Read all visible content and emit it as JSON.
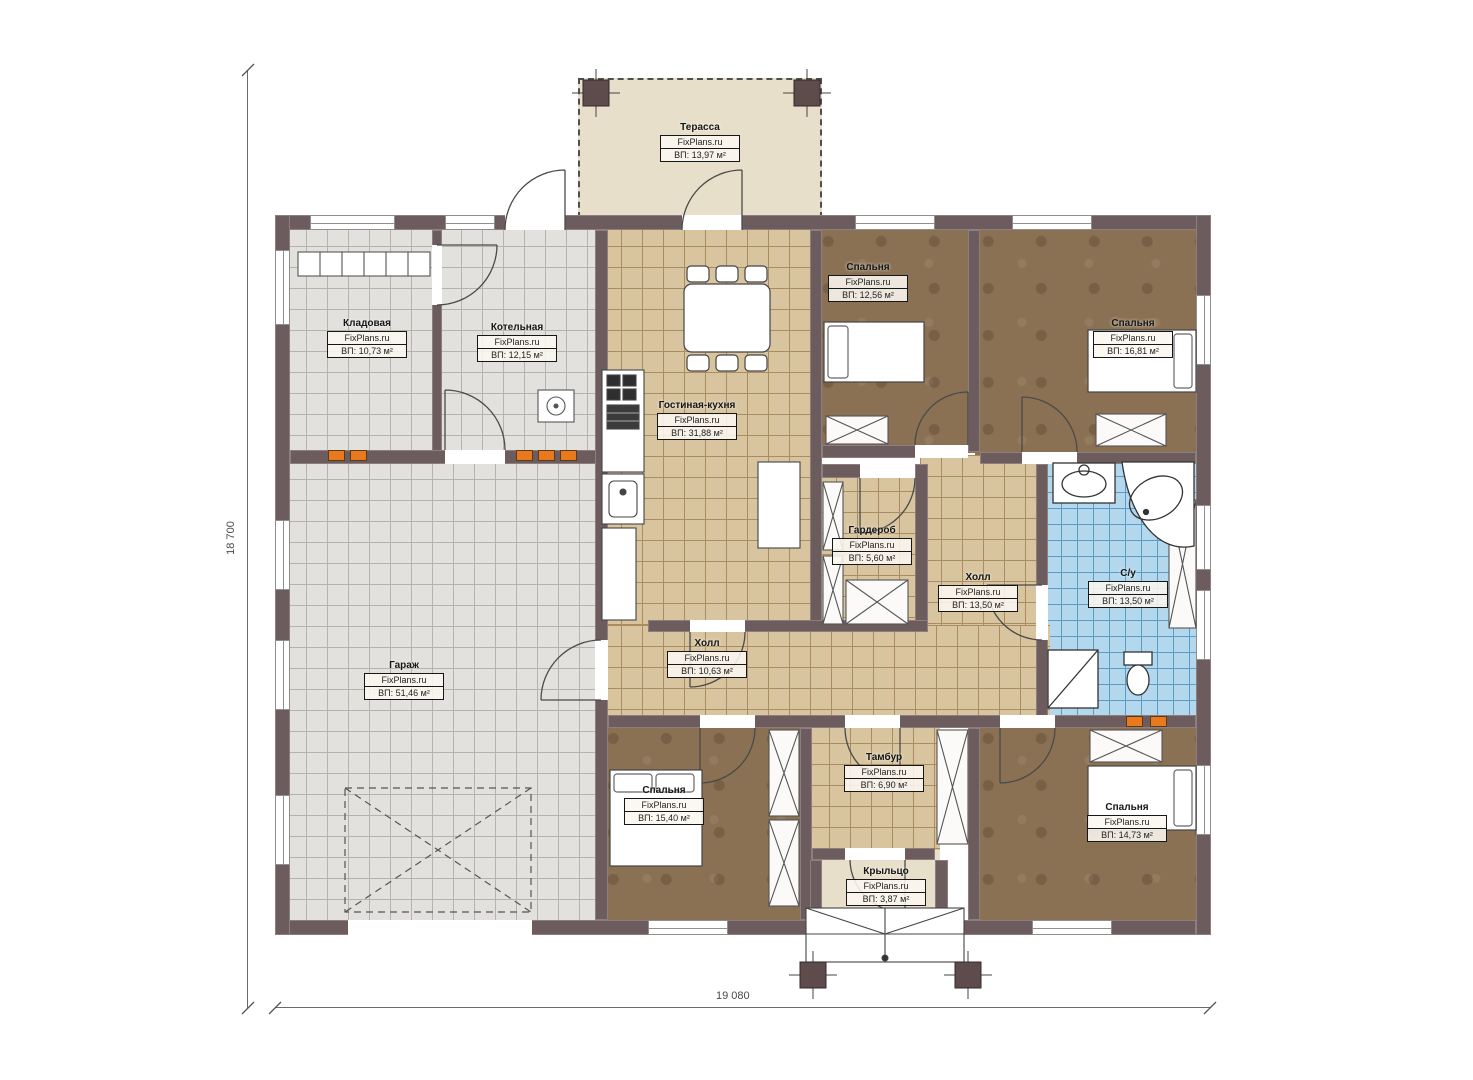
{
  "watermark": "FixPlans.ru",
  "dimensions": {
    "height_label": "18 700",
    "width_label": "19 080"
  },
  "colors": {
    "wall": "#6d5c5d",
    "tile_tan": "#d8c5a0",
    "tile_gray": "#e3e1de",
    "tile_blue": "#b3d7ed",
    "bedroom_brown": "#8a7153",
    "terrace_beige": "#e8dfca",
    "radiator_orange": "#e8791c"
  },
  "rooms": [
    {
      "name": "Терасса",
      "watermark": "FixPlans.ru",
      "area": "ВП: 13,97 м²"
    },
    {
      "name": "Кладовая",
      "watermark": "FixPlans.ru",
      "area": "ВП: 10,73 м²"
    },
    {
      "name": "Котельная",
      "watermark": "FixPlans.ru",
      "area": "ВП: 12,15 м²"
    },
    {
      "name": "Гостиная-кухня",
      "watermark": "FixPlans.ru",
      "area": "ВП: 31,88 м²"
    },
    {
      "name": "Спальня",
      "watermark": "FixPlans.ru",
      "area": "ВП: 12,56 м²"
    },
    {
      "name": "Спальня",
      "watermark": "FixPlans.ru",
      "area": "ВП: 16,81 м²"
    },
    {
      "name": "Гардероб",
      "watermark": "FixPlans.ru",
      "area": "ВП: 5,60 м²"
    },
    {
      "name": "Холл",
      "watermark": "FixPlans.ru",
      "area": "ВП: 13,50 м²"
    },
    {
      "name": "С/у",
      "watermark": "FixPlans.ru",
      "area": "ВП: 13,50 м²"
    },
    {
      "name": "Гараж",
      "watermark": "FixPlans.ru",
      "area": "ВП: 51,46 м²"
    },
    {
      "name": "Холл",
      "watermark": "FixPlans.ru",
      "area": "ВП: 10,63 м²"
    },
    {
      "name": "Спальня",
      "watermark": "FixPlans.ru",
      "area": "ВП: 15,40 м²"
    },
    {
      "name": "Тамбур",
      "watermark": "FixPlans.ru",
      "area": "ВП: 6,90 м²"
    },
    {
      "name": "Крыльцо",
      "watermark": "FixPlans.ru",
      "area": "ВП: 3,87 м²"
    },
    {
      "name": "Спальня",
      "watermark": "FixPlans.ru",
      "area": "ВП: 14,73 м²"
    }
  ]
}
